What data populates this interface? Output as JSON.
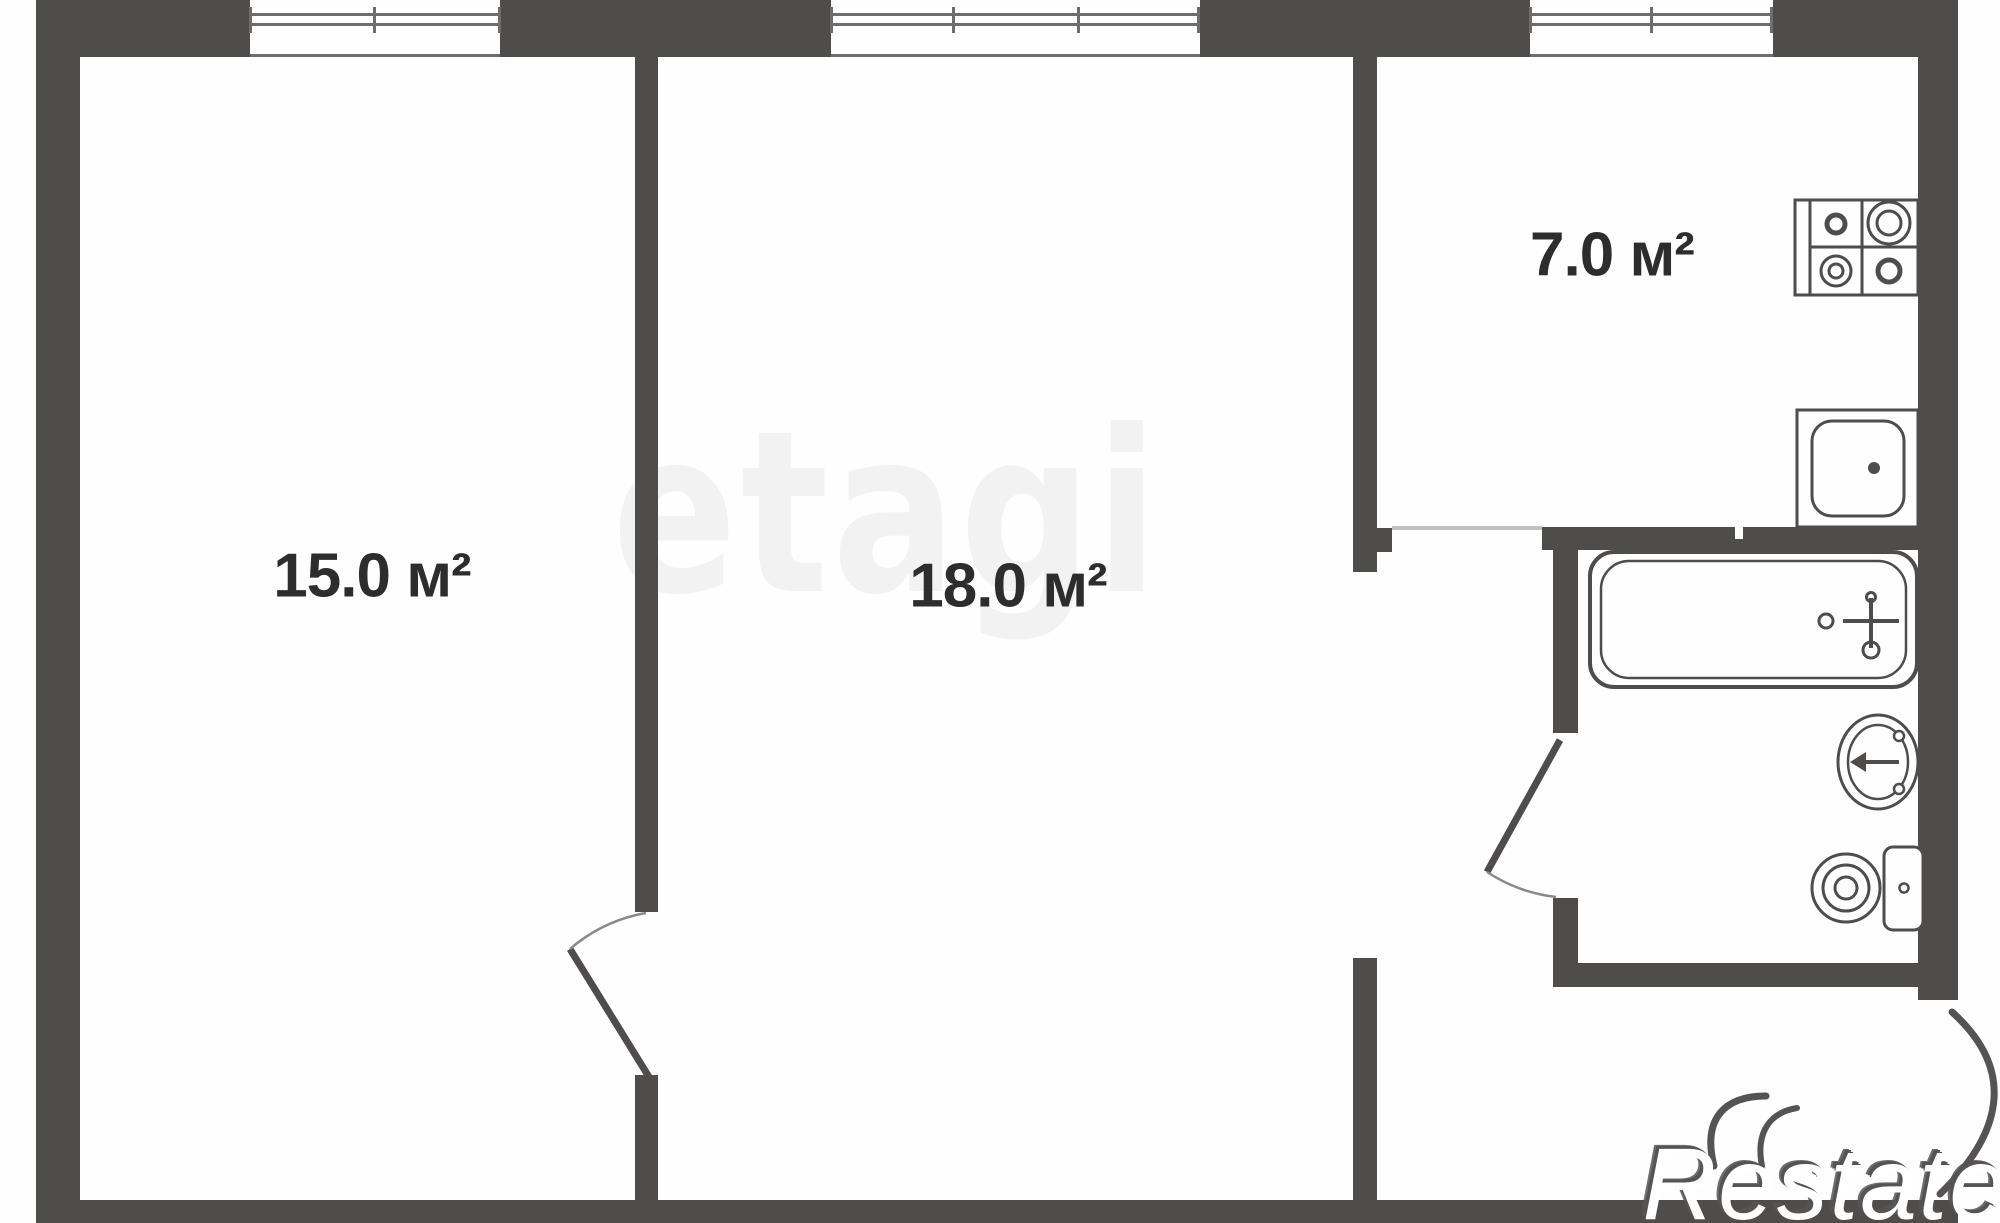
{
  "meta": {
    "kind": "apartment-floor-plan",
    "width_px": 2000,
    "height_px": 1223
  },
  "rooms": [
    {
      "name": "room-1",
      "area_label": "15.0 м²"
    },
    {
      "name": "room-2",
      "area_label": "18.0 м²"
    },
    {
      "name": "kitchen",
      "area_label": "7.0 м²"
    }
  ],
  "fixtures": [
    "stove",
    "kitchen-sink",
    "bathtub",
    "washbasin",
    "toilet"
  ],
  "windows": [
    "window-room-1",
    "window-room-2",
    "window-kitchen"
  ],
  "doors": [
    "door-room-1",
    "door-bathroom"
  ],
  "watermarks": {
    "center": "etagi",
    "corner": "Restate"
  },
  "colors": {
    "wall": "#4f4c4c",
    "label": "#2d2d2d",
    "watermark": "rgba(30,30,30,0.055)"
  }
}
